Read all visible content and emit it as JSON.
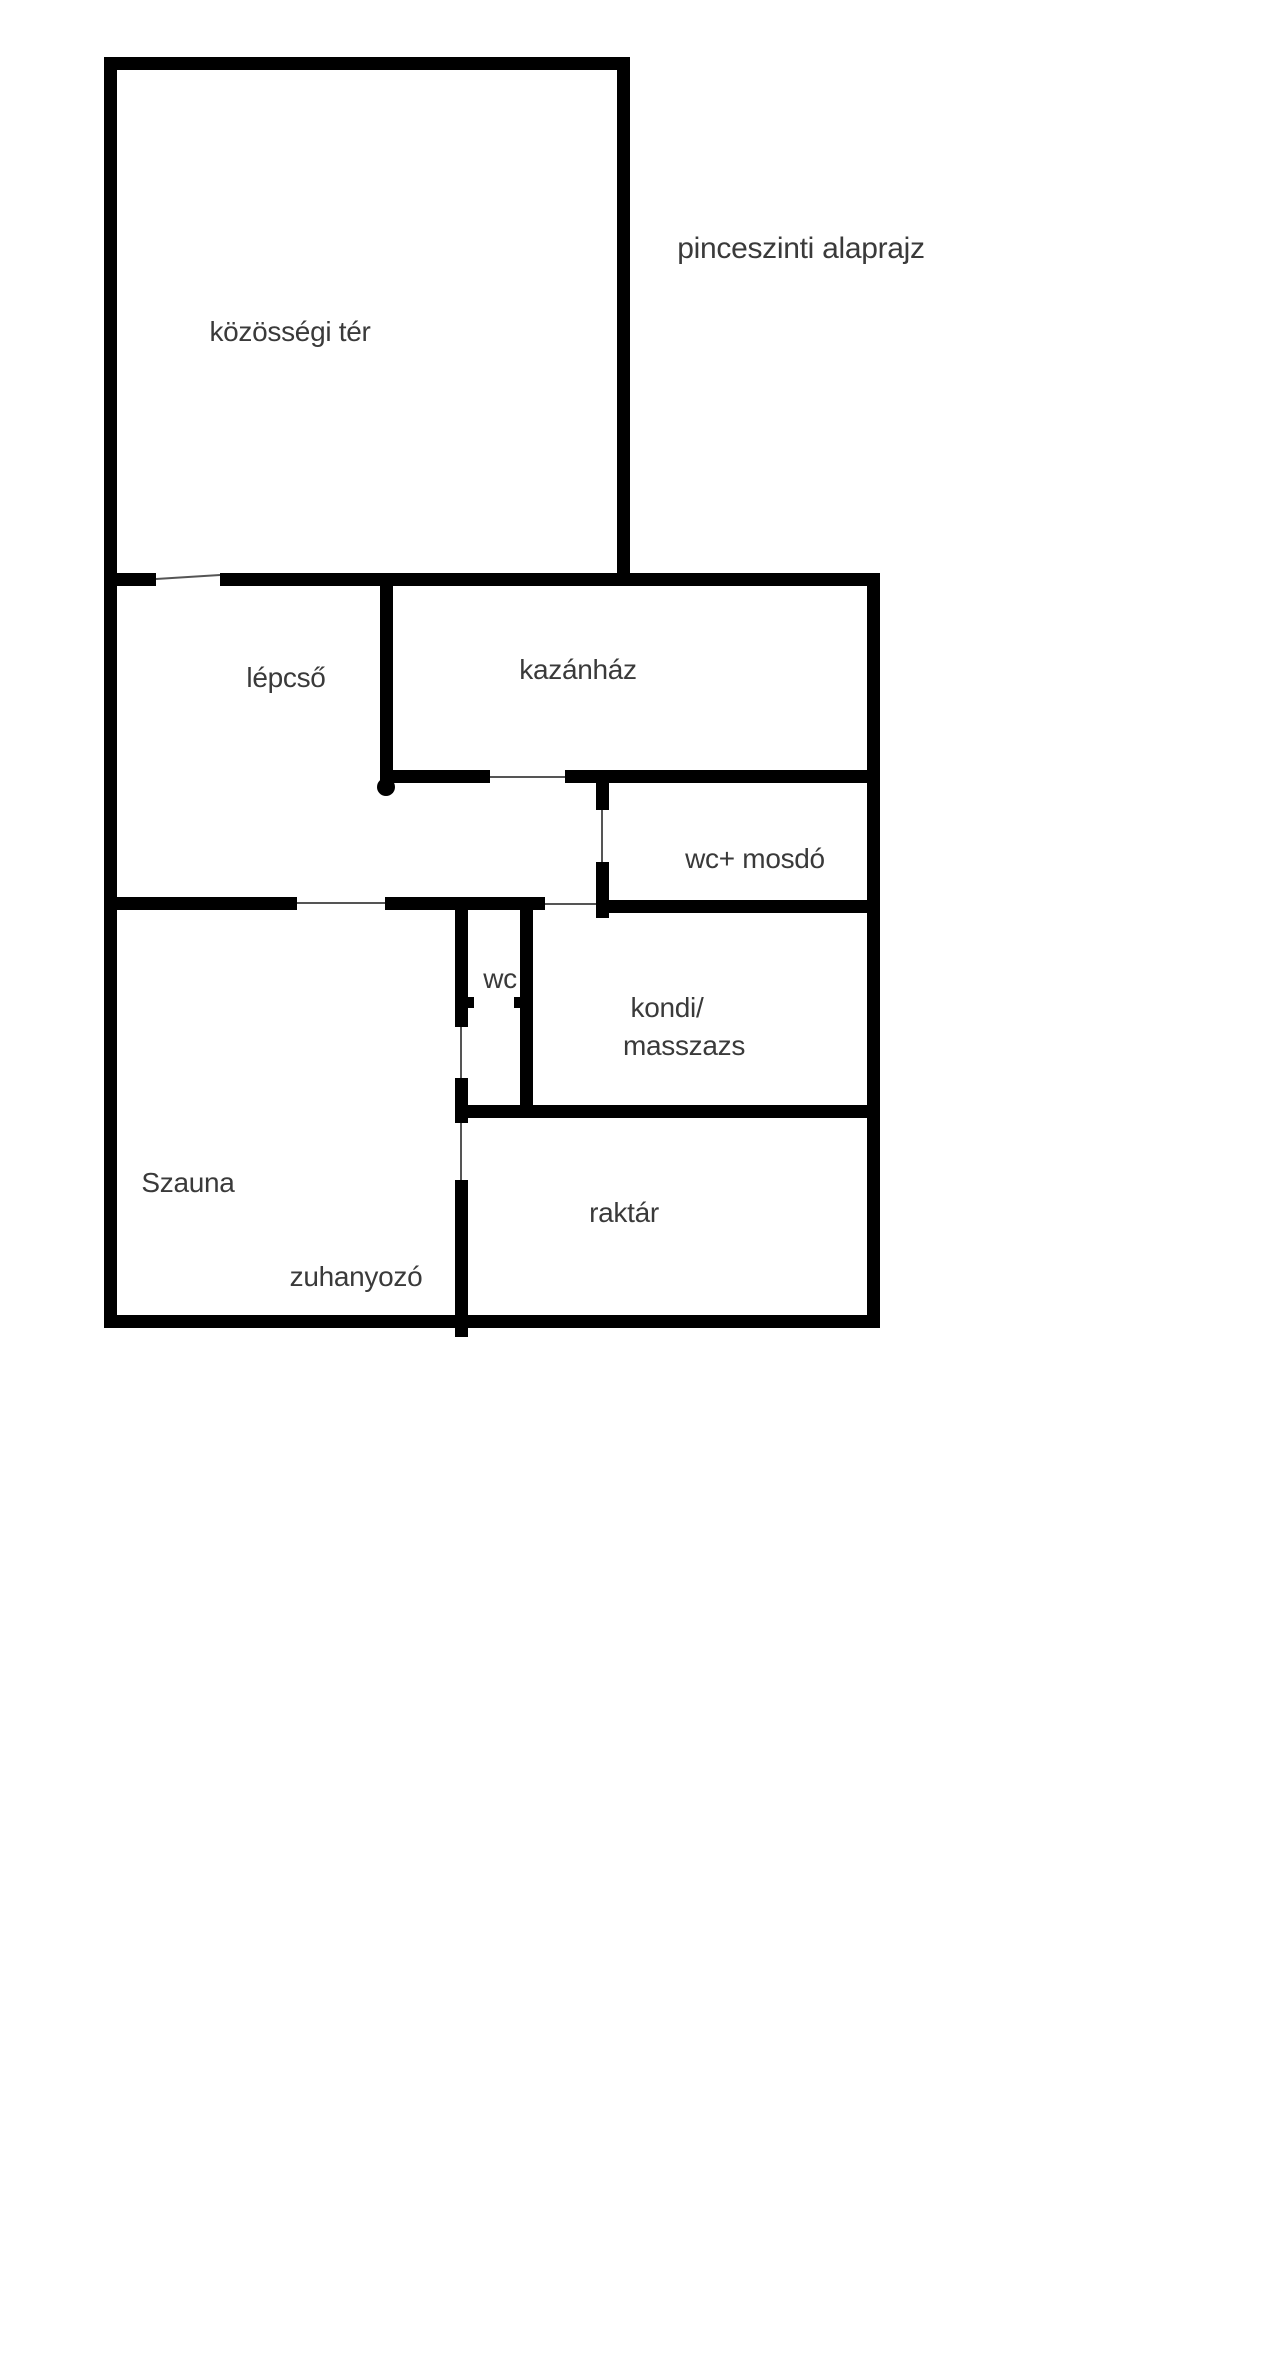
{
  "title": "pinceszinti alaprajz",
  "colors": {
    "wall": "#000000",
    "label_text": "#3a3a3a",
    "background": "#ffffff"
  },
  "rooms": [
    {
      "id": "kozossegi-ter",
      "label": "közösségi tér"
    },
    {
      "id": "lepcso",
      "label": "lépcső"
    },
    {
      "id": "kazanhaz",
      "label": "kazánház"
    },
    {
      "id": "wc-mosdo",
      "label": "wc+ mosdó"
    },
    {
      "id": "wc",
      "label": "wc"
    },
    {
      "id": "kondi-masszazs",
      "label_line1": "kondi/",
      "label_line2": "masszazs"
    },
    {
      "id": "szauna",
      "label": "Szauna"
    },
    {
      "id": "zuhanyozo",
      "label": "zuhanyozó"
    },
    {
      "id": "raktar",
      "label": "raktár"
    }
  ]
}
